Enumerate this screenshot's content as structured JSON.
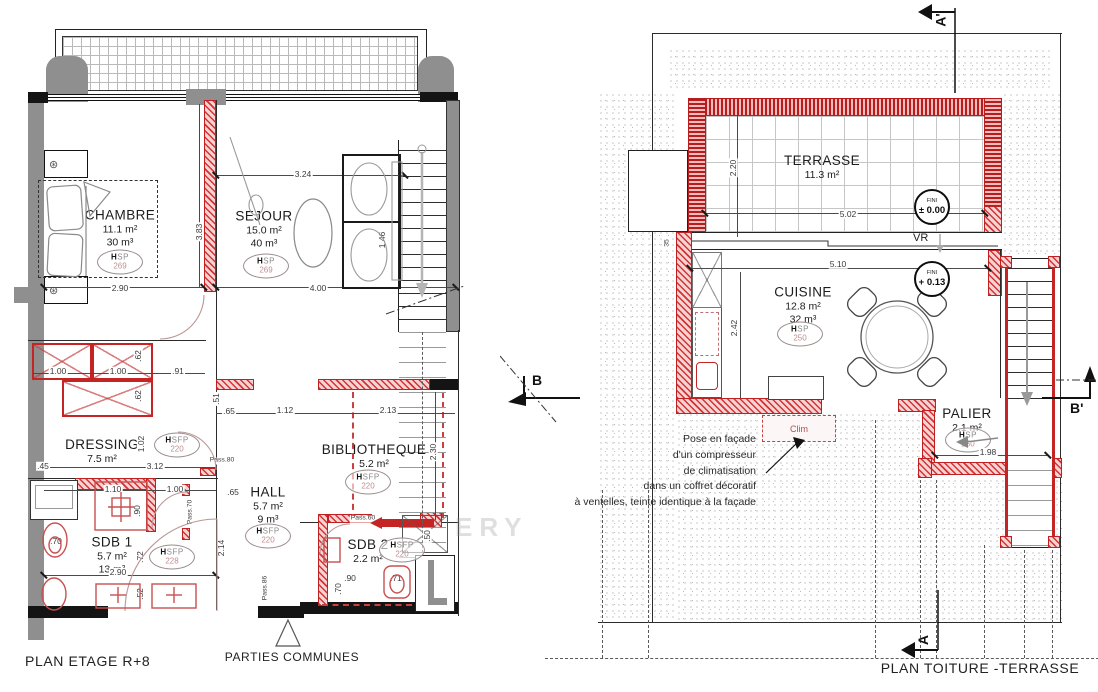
{
  "titles": {
    "left": "PLAN ETAGE R+8",
    "right": "PLAN TOITURE -TERRASSE",
    "common": "PARTIES COMMUNES"
  },
  "watermark": "ERY",
  "colors": {
    "red": "#c22222",
    "gray_wall": "#8f8f8f",
    "dim_text": "#3a3a3a"
  },
  "left": {
    "rooms": {
      "chambre": {
        "name": "CHAMBRE",
        "area": "11.1 m²",
        "volume": "30 m³",
        "h_label": "HSP",
        "h_value": "269"
      },
      "sejour": {
        "name": "SEJOUR",
        "area": "15.0 m²",
        "volume": "40 m³",
        "h_label": "HSP",
        "h_value": "269"
      },
      "dressing": {
        "name": "DRESSING",
        "area": "7.5 m²",
        "h_label": "HSFP",
        "h_value": "220"
      },
      "hall": {
        "name": "HALL",
        "area": "5.7 m²",
        "volume": "9 m³",
        "h_label": "HSFP",
        "h_value": "220"
      },
      "bibliotheque": {
        "name": "BIBLIOTHEQUE",
        "area": "5.2 m²",
        "h_label": "HSFP",
        "h_value": "220"
      },
      "sdb1": {
        "name": "SDB 1",
        "area": "5.7 m²",
        "volume": "13 m³",
        "h_label": "HSFP",
        "h_value": "228"
      },
      "sdb2": {
        "name": "SDB 2",
        "area": "2.2 m²",
        "h_label": "HSFP",
        "h_value": "220"
      }
    },
    "dims": {
      "chambre_w": "2.90",
      "chambre_h": "3.83",
      "sejour_w1": "3.24",
      "sejour_w2": "4.00",
      "sofa_d": "1.46",
      "cl1": "1.00",
      "cl2": "1.00",
      "cl3": ".91",
      "cl4": ".62",
      "cl5": ".62",
      "cl6": "1.02",
      "cl7": ".45",
      "dress_w": "3.12",
      "s1": "1.10",
      "s2": "1.00",
      "s3": ".90",
      "wc": ".70",
      "sdb1_h": ".72",
      "sdb1_w": "2.90",
      "sdb1_s": ".52",
      "hall_v": "2.14",
      "hall_65a": ".65",
      "hall_65b": ".65",
      "bib_51": ".51",
      "bib_w1": "1.12",
      "bib_w2": "2.13",
      "bib_h": "2.30",
      "bib_50": ".50",
      "sdb2_90": ".90",
      "sdb2_70": ".70",
      "sdb2_71": ".71",
      "pass80": "Pass.80",
      "pass70": "Pass.70",
      "pass60": "Pass.60",
      "pass86": "Pass.86"
    }
  },
  "right": {
    "rooms": {
      "terrasse": {
        "name": "TERRASSE",
        "area": "11.3 m²"
      },
      "cuisine": {
        "name": "CUISINE",
        "area": "12.8 m²",
        "volume": "32 m³",
        "h_label": "HSP",
        "h_value": "250"
      },
      "palier": {
        "name": "PALIER",
        "area": "2.1 m²",
        "h_label": "HSP",
        "h_value": "250"
      }
    },
    "badges": {
      "terrasse": {
        "label": "FINI",
        "value": "± 0.00"
      },
      "cuisine": {
        "label": "FINI",
        "value": "+ 0.13"
      }
    },
    "dims": {
      "terr_h": "2.20",
      "terr_w": "5.02",
      "cuis_w": "5.10",
      "cuis_h": "2.42",
      "pal_w": "1.98",
      "v35": "35"
    },
    "labels": {
      "vr": "VR",
      "clim": "Clim"
    },
    "note": "Pose en façade\nd'un compresseur\nde climatisation\ndans un coffret décoratif\nà ventelles, teinte identique à la façade",
    "sections": {
      "a_prime": "A'",
      "a": "A",
      "b": "B",
      "b_prime": "B'"
    }
  }
}
